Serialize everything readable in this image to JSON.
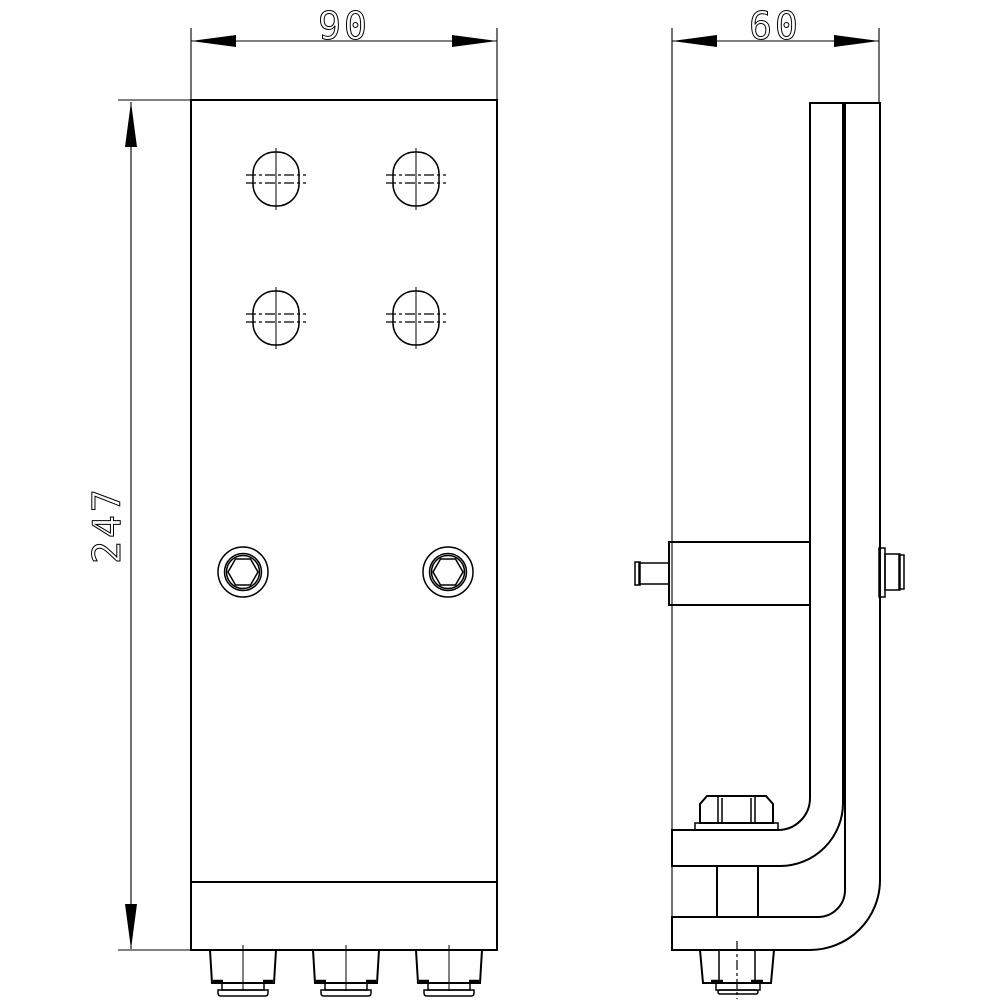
{
  "page": {
    "background_color": "#ffffff",
    "line_color": "#000000",
    "content_type": "2D engineering drawing, two orthographic views of a beam clamp bracket"
  },
  "dimensions": {
    "width": {
      "label": "90"
    },
    "depth": {
      "label": "60"
    },
    "height": {
      "label": "247"
    }
  }
}
